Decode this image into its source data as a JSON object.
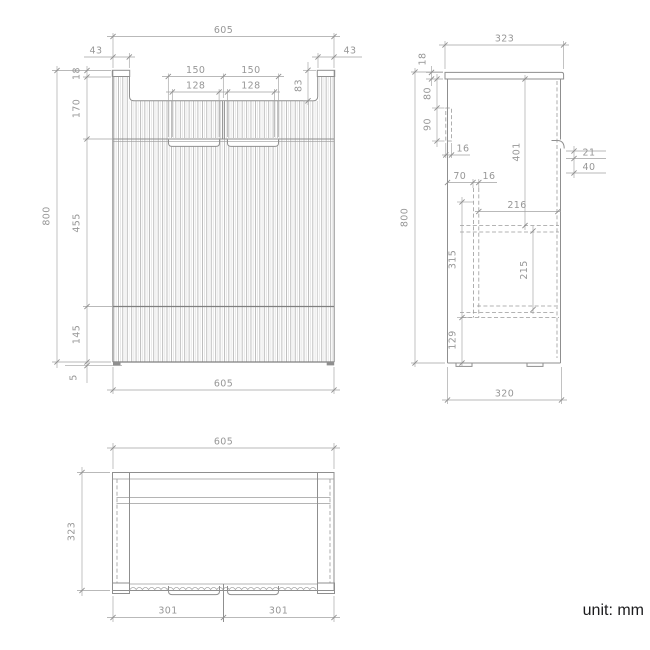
{
  "unit_label": "unit: mm",
  "views": {
    "front": {
      "overall_width": "605",
      "overall_height": "800",
      "corner_left": "43",
      "corner_right": "43",
      "top_cap": "18",
      "upper_height": "170",
      "handle_left_outer": "150",
      "handle_right_outer": "150",
      "handle_left_inner": "128",
      "handle_right_inner": "128",
      "recess_depth": "83",
      "door_height": "455",
      "kick_height": "145",
      "foot_height": "5",
      "bottom_width": "605"
    },
    "side": {
      "overall_depth": "323",
      "overall_height": "800",
      "top_thickness": "18",
      "rail_offset": "80",
      "rail_height": "90",
      "rail_thickness": "16",
      "interior_height": "401",
      "handle_lip": "21",
      "handle_depth": "40",
      "back_offset": "70",
      "panel_thickness": "16",
      "shelf_depth": "216",
      "drawer_space": "315",
      "inner_space": "215",
      "base_height": "129",
      "body_depth": "320"
    },
    "top": {
      "overall_width": "605",
      "overall_depth": "323",
      "door_left": "301",
      "door_right": "301"
    }
  }
}
